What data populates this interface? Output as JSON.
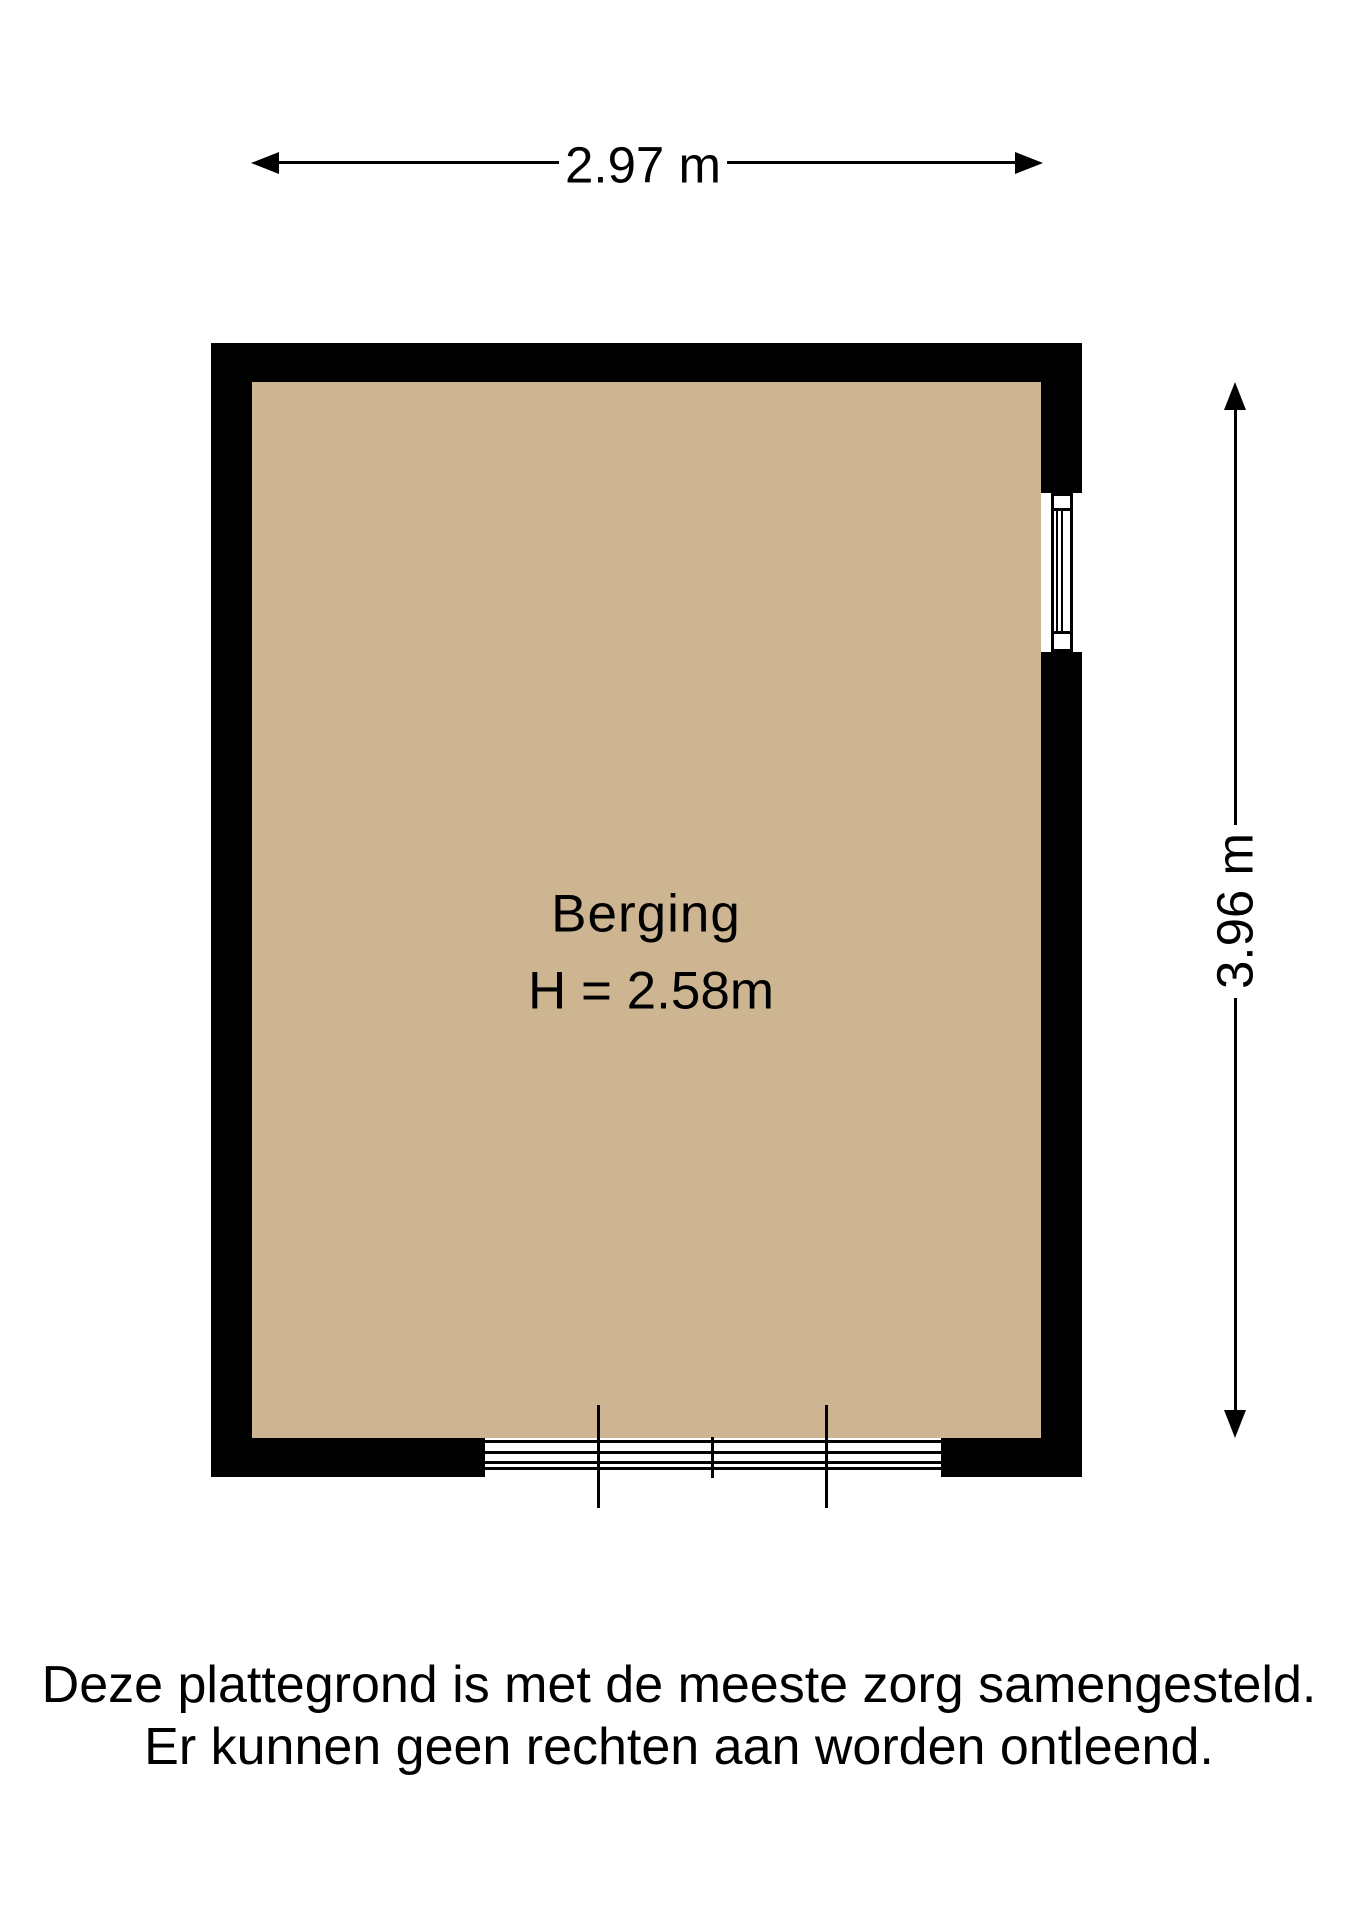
{
  "colors": {
    "floor": "#cdb592",
    "wall": "#000000",
    "line": "#000000",
    "text": "#000000",
    "bg": "#ffffff"
  },
  "dimensions": {
    "width_label": "2.97 m",
    "height_label": "3.96 m"
  },
  "room": {
    "name": "Berging",
    "ceiling_height_label": "H = 2.58m"
  },
  "disclaimer": {
    "line1": "Deze plattegrond is met de meeste zorg samengesteld.",
    "line2": "Er kunnen geen rechten aan worden ontleend."
  }
}
